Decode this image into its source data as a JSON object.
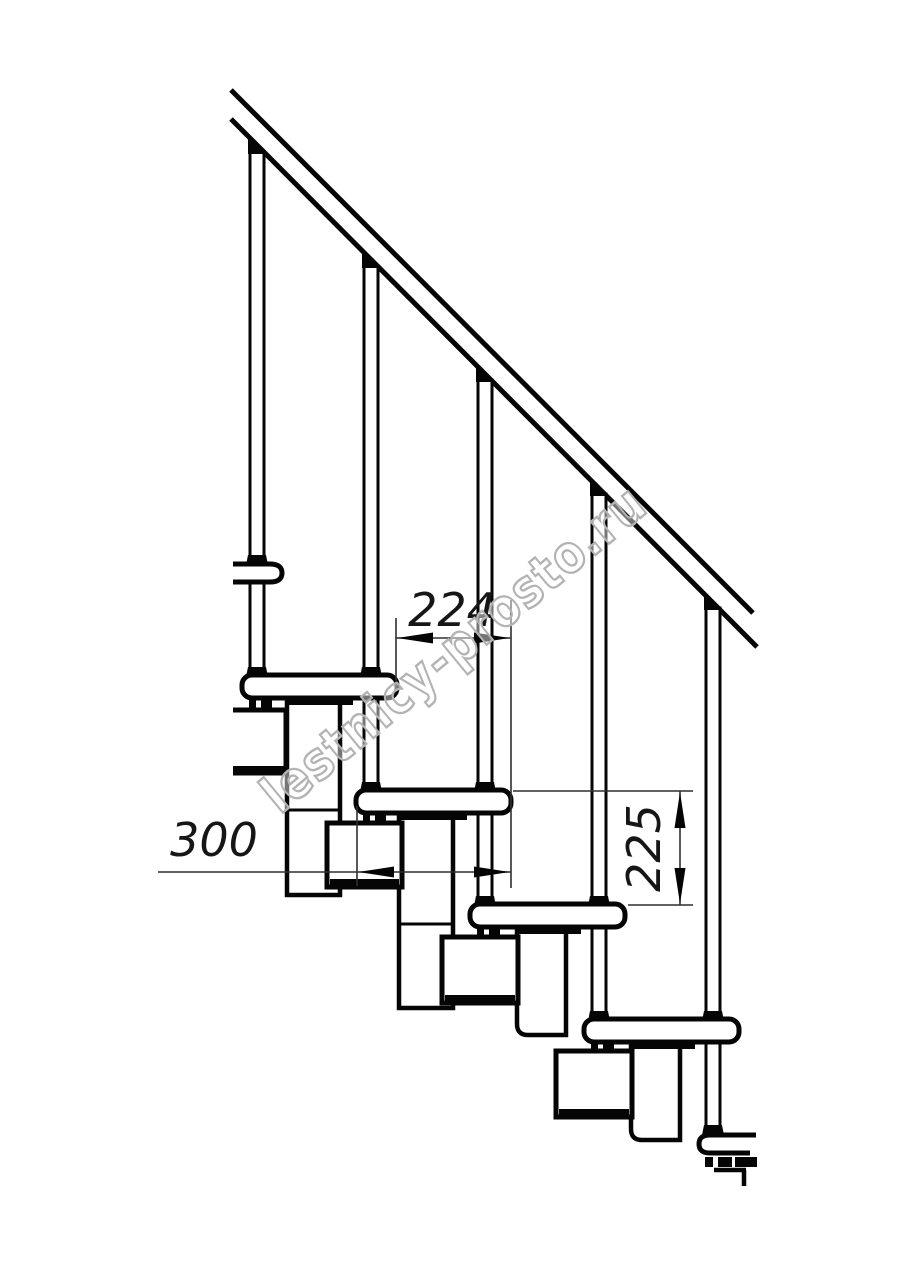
{
  "document": {
    "type": "technical-drawing",
    "subject": "modular staircase side elevation fragment",
    "background": "#ffffff",
    "line_color": "#050505",
    "dimension_color": "#2f2f2f",
    "watermark": {
      "text": "lestnicy-prosto.ru",
      "color": "#b3b3b3"
    },
    "dimensions": [
      {
        "id": "step-run",
        "value": "224",
        "unit": "mm",
        "orientation": "horizontal"
      },
      {
        "id": "tread-depth",
        "value": "300",
        "unit": "mm",
        "orientation": "horizontal"
      },
      {
        "id": "riser-height",
        "value": "225",
        "unit": "mm",
        "orientation": "vertical"
      }
    ]
  }
}
